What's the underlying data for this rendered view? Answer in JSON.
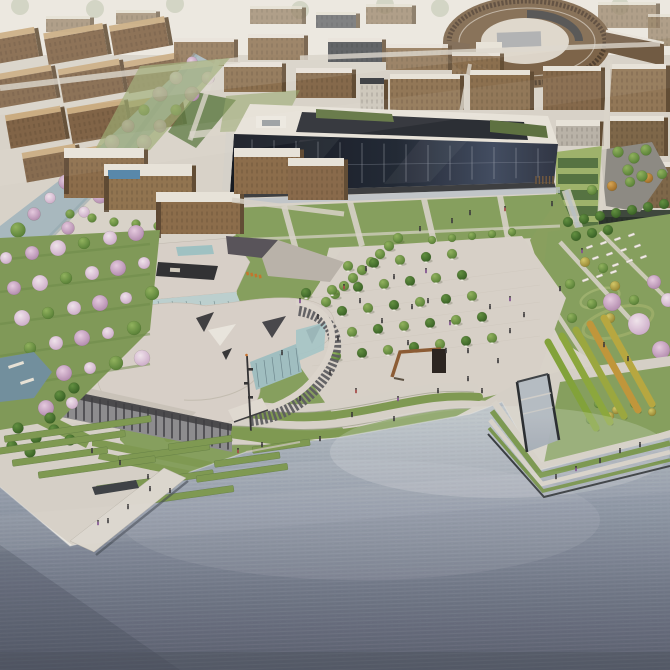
{
  "image": {
    "type": "architectural-aerial-rendering",
    "description": "Aerial rendering of a waterfront campus masterplan with brown city blocks, an elliptical courtyard building, a long dark-glass academic building with green roofs, a blossom-lined canal, a sculptural cultural center, a tree-filled central paved plaza with a corten gateway sculpture, terraced wave lawns, stepped green embankments, a pier and a wide rippled lake.",
    "width": 670,
    "height": 670
  },
  "palette": {
    "haze": "#eceae3",
    "ground": "#d9d5cc",
    "lawn": "#84a05e",
    "lawn_dark": "#6b8a49",
    "plaza_paving": "#d8d3cb",
    "concrete": "#d6d2ca",
    "canal_water": "#a7bac2",
    "water_light": "#b3bdc6",
    "water_mid": "#8e99a9",
    "water_deep": "#555c6e",
    "building_tan_face": "#8a6f4f",
    "building_tan_side": "#5e4a33",
    "roof_white": "#e9e5dd",
    "roof_tan": "#c9ab80",
    "facade_dark": "#1b2330",
    "roof_green": "#5e7340",
    "glass_teal": "#a4c7ca",
    "roof_light_gray": "#d8d2cb",
    "wall_dark_gray": "#4a4b50",
    "tree_green": "#6f9b48",
    "tree_conifer": "#47763a",
    "tree_yellow": "#bfb94f",
    "tree_autumn": "#c2923c",
    "blossom_pink": "#dcc2d9",
    "blossom_white": "#eae0e9",
    "sculpture_rust": "#8a5a33",
    "people_dark": "#3a3a3e",
    "people_purple": "#7d4e91",
    "people_red": "#a34646",
    "bench_white": "#f2efe9",
    "grass_step": "#7c9a52",
    "step_shadow": "#5e7c42"
  },
  "scene": {
    "landmarks": [
      "distant city blocks",
      "elliptical courtyard building",
      "dark glass academic building",
      "blossom-lined canal",
      "cultural center with curved roofs",
      "central plaza with tree bosque",
      "corten gateway sculpture",
      "terraced wave lawns",
      "blossom orchard",
      "stepped waterfront embankment",
      "boat slip",
      "pier",
      "lake"
    ]
  }
}
